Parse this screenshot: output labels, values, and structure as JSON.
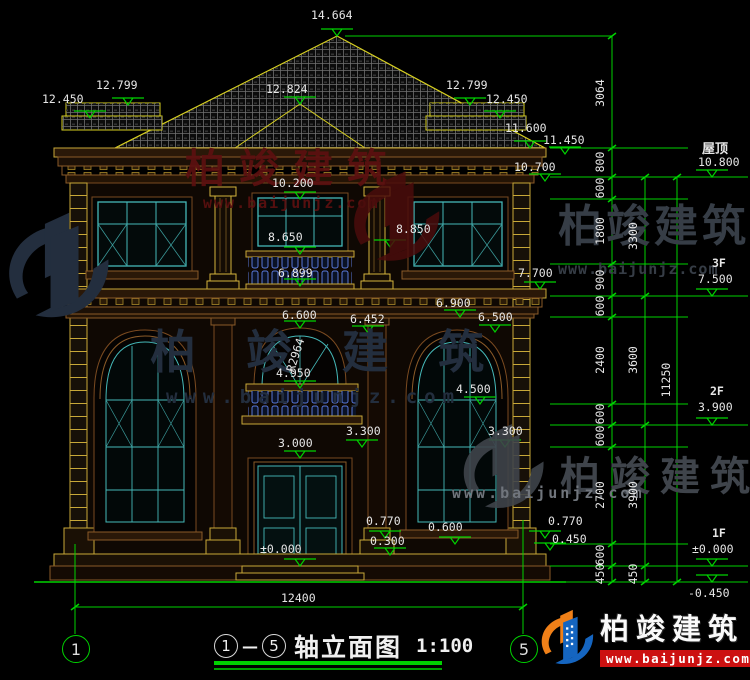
{
  "drawing": {
    "title": {
      "axis_start": "1",
      "axis_end": "5",
      "name": "轴立面图",
      "scale": "1:100"
    },
    "total_width_dim": "12400",
    "axis_bubble_left": "1",
    "axis_bubble_right": "5",
    "radius_label": "R2964",
    "marks": [
      {
        "name": "roof-peak",
        "t": "14.664"
      },
      {
        "name": "left-wing-ridge",
        "t": "12.799"
      },
      {
        "name": "left-wing-eave",
        "t": "12.450"
      },
      {
        "name": "center-gable",
        "t": "12.824"
      },
      {
        "name": "right-wing-ridge",
        "t": "12.799"
      },
      {
        "name": "right-wing-eave",
        "t": "12.450"
      },
      {
        "name": "main-eave",
        "t": "11.600"
      },
      {
        "name": "eave-soffit",
        "t": "11.450"
      },
      {
        "name": "cornice-bottom",
        "t": "10.700"
      },
      {
        "name": "f3-window-head",
        "t": "10.200"
      },
      {
        "name": "f3-column-base",
        "t": "8.850"
      },
      {
        "name": "f3-balcony-rail",
        "t": "8.650"
      },
      {
        "name": "f3-sill-band",
        "t": "7.700"
      },
      {
        "name": "band-top-center",
        "t": "6.899"
      },
      {
        "name": "center-arch-head",
        "t": "6.600"
      },
      {
        "name": "capital-top",
        "t": "6.452"
      },
      {
        "name": "band-top-right",
        "t": "6.900"
      },
      {
        "name": "right-arch-head",
        "t": "6.500"
      },
      {
        "name": "f2-balcony-rail",
        "t": "4.950"
      },
      {
        "name": "right-mid-sill",
        "t": "4.500"
      },
      {
        "name": "door-head",
        "t": "3.000"
      },
      {
        "name": "center-window-head-1f",
        "t": "3.300"
      },
      {
        "name": "right-window-head-1f",
        "t": "3.300"
      },
      {
        "name": "center-pedestal-top",
        "t": "0.770"
      },
      {
        "name": "center-pedestal-base",
        "t": "0.300"
      },
      {
        "name": "right-sill-1f",
        "t": "0.600"
      },
      {
        "name": "entry-level",
        "t": "±0.000"
      },
      {
        "name": "right-pedestal-top",
        "t": "0.770"
      },
      {
        "name": "right-pedestal-base",
        "t": "0.450"
      }
    ]
  },
  "right_panel": {
    "chain_inner": [
      "3064",
      "800",
      "600",
      "1800",
      "900",
      "600",
      "2400",
      "600",
      "600",
      "2700",
      "600",
      "450"
    ],
    "chain_mid": [
      "3300",
      "3600",
      "3900",
      "450"
    ],
    "chain_total": "11250",
    "floors": [
      {
        "label": "屋顶",
        "elev": "10.800"
      },
      {
        "label": "3F",
        "elev": "7.500"
      },
      {
        "label": "2F",
        "elev": "3.900"
      },
      {
        "label": "1F",
        "elev": "±0.000"
      },
      {
        "label": "",
        "elev": "-0.450"
      }
    ]
  },
  "watermark": {
    "brand": "柏竣建筑",
    "url": "www.baijunjz.com"
  },
  "logo": {
    "brand": "柏竣建筑",
    "url": "www.baijunjz.com"
  },
  "colors": {
    "background": "#000000",
    "dim_green": "#00d200",
    "dim_text": "#e6e6e6",
    "wall_outline": "#7a4a20",
    "trim_yellow": "#c8a838",
    "window_teal": "#45b8b8",
    "roof_edge": "#d8d020",
    "baluster_blue": "#5878d8",
    "logo_blue": "#1565c0",
    "logo_orange": "#f08018",
    "logo_red": "#cc1111"
  }
}
